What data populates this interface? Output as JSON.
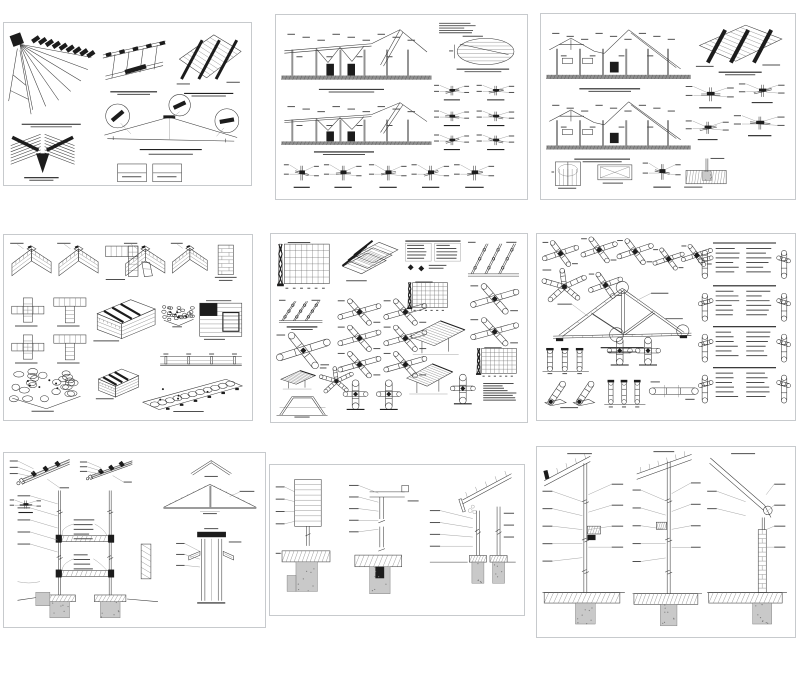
{
  "page": {
    "background": "#ffffff",
    "sheet_border": "#c7cacd",
    "ink": "#3a3a3a",
    "dark_fill": "#1c1c1c",
    "concrete_fill": "#c9c9c9",
    "grid": {
      "rows": 3,
      "cols": 3
    }
  },
  "sheets": [
    {
      "id": "sheet-1",
      "name": "roof-framing-isometrics",
      "x": 3,
      "y": 22,
      "w": 249,
      "h": 164,
      "elements": [
        {
          "t": "fan",
          "x": 1,
          "y": 5,
          "w": 35,
          "h": 54,
          "s": 1
        },
        {
          "t": "caption",
          "x": 7,
          "y": 62,
          "w": 24,
          "h": 5,
          "s": 2
        },
        {
          "t": "isobeams",
          "x": 40,
          "y": 8,
          "w": 26,
          "h": 31,
          "s": 3
        },
        {
          "t": "caption",
          "x": 43,
          "y": 42,
          "w": 19,
          "h": 5,
          "s": 4
        },
        {
          "t": "isopanel",
          "x": 70,
          "y": 6,
          "w": 27,
          "h": 34,
          "s": 5
        },
        {
          "t": "caption",
          "x": 73,
          "y": 43,
          "w": 20,
          "h": 5,
          "s": 6
        },
        {
          "t": "isocorner",
          "x": 2,
          "y": 67,
          "w": 27,
          "h": 27,
          "s": 7
        },
        {
          "t": "caption",
          "x": 8,
          "y": 95,
          "w": 14,
          "h": 5,
          "s": 8
        },
        {
          "t": "trusscall",
          "x": 37,
          "y": 47,
          "w": 60,
          "h": 37,
          "s": 9
        },
        {
          "t": "legend2",
          "x": 46,
          "y": 87,
          "w": 26,
          "h": 11,
          "s": 10
        }
      ]
    },
    {
      "id": "sheet-2",
      "name": "building-elevations-and-details",
      "x": 275,
      "y": 14,
      "w": 253,
      "h": 186,
      "elements": [
        {
          "t": "section",
          "v": "a",
          "x": 2,
          "y": 6,
          "w": 60,
          "h": 32,
          "s": 1
        },
        {
          "t": "caption",
          "x": 17,
          "y": 40,
          "w": 26,
          "h": 5,
          "s": 2
        },
        {
          "t": "section",
          "v": "a",
          "x": 2,
          "y": 46,
          "w": 60,
          "h": 27,
          "s": 3
        },
        {
          "t": "caption",
          "x": 15,
          "y": 74,
          "w": 24,
          "h": 5,
          "s": 4
        },
        {
          "t": "textblock",
          "x": 65,
          "y": 4,
          "w": 15,
          "h": 7,
          "s": 5
        },
        {
          "t": "ellipseplan",
          "x": 69,
          "y": 11,
          "w": 27,
          "h": 17,
          "s": 6
        },
        {
          "t": "caption",
          "x": 72,
          "y": 29,
          "w": 21,
          "h": 5,
          "s": 7
        },
        {
          "t": "smalldetail",
          "x": 63,
          "y": 36,
          "w": 14,
          "h": 11,
          "s": 8
        },
        {
          "t": "smalldetail",
          "x": 80,
          "y": 36,
          "w": 15,
          "h": 11,
          "s": 9
        },
        {
          "t": "smalldetail",
          "x": 63,
          "y": 50,
          "w": 14,
          "h": 11,
          "s": 10
        },
        {
          "t": "smalldetail",
          "x": 80,
          "y": 50,
          "w": 15,
          "h": 11,
          "s": 11
        },
        {
          "t": "smalldetail",
          "x": 63,
          "y": 63,
          "w": 14,
          "h": 11,
          "s": 12
        },
        {
          "t": "smalldetail",
          "x": 80,
          "y": 63,
          "w": 15,
          "h": 11,
          "s": 13
        },
        {
          "t": "smalldetail",
          "x": 3,
          "y": 78,
          "w": 14,
          "h": 17,
          "s": 14
        },
        {
          "t": "smalldetail",
          "x": 19,
          "y": 78,
          "w": 15,
          "h": 17,
          "s": 15
        },
        {
          "t": "smalldetail",
          "x": 37,
          "y": 78,
          "w": 15,
          "h": 17,
          "s": 16
        },
        {
          "t": "smalldetail",
          "x": 54,
          "y": 78,
          "w": 15,
          "h": 17,
          "s": 17
        },
        {
          "t": "smalldetail",
          "x": 71,
          "y": 78,
          "w": 16,
          "h": 17,
          "s": 18
        }
      ]
    },
    {
      "id": "sheet-3",
      "name": "asymmetric-roof-sections-and-details",
      "x": 540,
      "y": 13,
      "w": 256,
      "h": 187,
      "elements": [
        {
          "t": "section",
          "v": "b",
          "x": 2,
          "y": 6,
          "w": 57,
          "h": 32,
          "s": 1
        },
        {
          "t": "caption",
          "x": 15,
          "y": 40,
          "w": 24,
          "h": 5,
          "s": 2
        },
        {
          "t": "section",
          "v": "b",
          "x": 2,
          "y": 45,
          "w": 57,
          "h": 31,
          "s": 3
        },
        {
          "t": "caption",
          "x": 13,
          "y": 78,
          "w": 22,
          "h": 5,
          "s": 4
        },
        {
          "t": "isopanel",
          "x": 61,
          "y": 5,
          "w": 35,
          "h": 25,
          "s": 5
        },
        {
          "t": "caption",
          "x": 70,
          "y": 31,
          "w": 17,
          "h": 5,
          "s": 6
        },
        {
          "t": "smalldetail",
          "x": 57,
          "y": 36,
          "w": 19,
          "h": 16,
          "s": 7
        },
        {
          "t": "smalldetail",
          "x": 78,
          "y": 35,
          "w": 18,
          "h": 14,
          "s": 8
        },
        {
          "t": "smalldetail",
          "x": 57,
          "y": 55,
          "w": 17,
          "h": 14,
          "s": 9
        },
        {
          "t": "smalldetail",
          "x": 76,
          "y": 52,
          "w": 20,
          "h": 15,
          "s": 10
        },
        {
          "t": "opening",
          "v": "door",
          "x": 4,
          "y": 79,
          "w": 13,
          "h": 16,
          "s": 11
        },
        {
          "t": "opening",
          "v": "window",
          "x": 21,
          "y": 80,
          "w": 16,
          "h": 13,
          "s": 12
        },
        {
          "t": "smalldetail",
          "x": 40,
          "y": 77,
          "w": 15,
          "h": 18,
          "s": 13
        },
        {
          "t": "foundsec",
          "x": 56,
          "y": 77,
          "w": 18,
          "h": 18,
          "s": 14
        }
      ]
    },
    {
      "id": "sheet-4",
      "name": "masonry-bond-details",
      "x": 3,
      "y": 234,
      "w": 250,
      "h": 187,
      "elements": [
        {
          "t": "brickiso",
          "v": "l",
          "x": 2,
          "y": 4,
          "w": 18,
          "h": 25,
          "s": 1
        },
        {
          "t": "brickiso",
          "v": "l",
          "x": 21,
          "y": 4,
          "w": 18,
          "h": 25,
          "s": 2
        },
        {
          "t": "brickplan",
          "v": "l",
          "x": 41,
          "y": 6,
          "w": 13,
          "h": 19,
          "s": 3
        },
        {
          "t": "brickiso",
          "v": "t",
          "x": 48,
          "y": 4,
          "w": 18,
          "h": 25,
          "s": 4
        },
        {
          "t": "brickiso",
          "v": "l",
          "x": 67,
          "y": 4,
          "w": 16,
          "h": 23,
          "s": 5
        },
        {
          "t": "brickcol",
          "x": 84,
          "y": 5,
          "w": 11,
          "h": 21,
          "s": 6
        },
        {
          "t": "brickplan",
          "v": "x",
          "x": 3,
          "y": 34,
          "w": 13,
          "h": 16,
          "s": 7
        },
        {
          "t": "brickplan",
          "v": "t",
          "x": 20,
          "y": 34,
          "w": 13,
          "h": 16,
          "s": 8
        },
        {
          "t": "brickplan",
          "v": "x",
          "x": 3,
          "y": 54,
          "w": 13,
          "h": 16,
          "s": 9
        },
        {
          "t": "brickplan",
          "v": "t",
          "x": 20,
          "y": 54,
          "w": 13,
          "h": 16,
          "s": 10
        },
        {
          "t": "brickisowall",
          "x": 36,
          "y": 33,
          "w": 26,
          "h": 25,
          "s": 11
        },
        {
          "t": "stoneiso",
          "x": 64,
          "y": 37,
          "w": 13,
          "h": 13,
          "s": 12
        },
        {
          "t": "brickelev",
          "x": 79,
          "y": 35,
          "w": 17,
          "h": 23,
          "s": 13
        },
        {
          "t": "wallstrip",
          "x": 63,
          "y": 63,
          "w": 33,
          "h": 9,
          "s": 14
        },
        {
          "t": "stoneiso",
          "x": 2,
          "y": 70,
          "w": 30,
          "h": 26,
          "s": 15
        },
        {
          "t": "brickisowall",
          "x": 37,
          "y": 71,
          "w": 18,
          "h": 18,
          "s": 16
        },
        {
          "t": "stonewalliso",
          "x": 56,
          "y": 76,
          "w": 41,
          "h": 20,
          "s": 17
        }
      ]
    },
    {
      "id": "sheet-5",
      "name": "bamboo-lashing-and-roof-details",
      "x": 270,
      "y": 233,
      "w": 258,
      "h": 190,
      "elements": [
        {
          "t": "mesh",
          "x": 2,
          "y": 4,
          "w": 22,
          "h": 27,
          "s": 1
        },
        {
          "t": "layeredroof",
          "x": 27,
          "y": 4,
          "w": 23,
          "h": 22,
          "s": 2
        },
        {
          "t": "texttable",
          "x": 52,
          "y": 3,
          "w": 23,
          "h": 19,
          "s": 3
        },
        {
          "t": "battens",
          "x": 77,
          "y": 4,
          "w": 20,
          "h": 20,
          "s": 4
        },
        {
          "t": "battens",
          "x": 3,
          "y": 35,
          "w": 17,
          "h": 13,
          "s": 5
        },
        {
          "t": "caption",
          "x": 6,
          "y": 49,
          "w": 12,
          "h": 4,
          "s": 6
        },
        {
          "t": "bambooX",
          "x": 2,
          "y": 53,
          "w": 21,
          "h": 18,
          "s": 7
        },
        {
          "t": "thatch",
          "x": 3,
          "y": 72,
          "w": 15,
          "h": 11,
          "s": 8
        },
        {
          "t": "star",
          "x": 19,
          "y": 71,
          "w": 13,
          "h": 14,
          "s": 9
        },
        {
          "t": "trapframe",
          "x": 2,
          "y": 85,
          "w": 20,
          "h": 13,
          "s": 10
        },
        {
          "t": "bambooX",
          "x": 26,
          "y": 35,
          "w": 17,
          "h": 13,
          "s": 11
        },
        {
          "t": "bambooX",
          "x": 44,
          "y": 35,
          "w": 17,
          "h": 13,
          "s": 12
        },
        {
          "t": "bambooX",
          "x": 26,
          "y": 49,
          "w": 17,
          "h": 13,
          "s": 13
        },
        {
          "t": "bambooX",
          "x": 44,
          "y": 49,
          "w": 17,
          "h": 13,
          "s": 14
        },
        {
          "t": "bambooX",
          "x": 26,
          "y": 63,
          "w": 17,
          "h": 13,
          "s": 15
        },
        {
          "t": "bambooX",
          "x": 44,
          "y": 63,
          "w": 17,
          "h": 13,
          "s": 16
        },
        {
          "t": "vertjoint",
          "x": 28,
          "y": 78,
          "w": 10,
          "h": 17,
          "s": 17
        },
        {
          "t": "vertjoint",
          "x": 41,
          "y": 78,
          "w": 10,
          "h": 17,
          "s": 18
        },
        {
          "t": "mesh",
          "x": 53,
          "y": 25,
          "w": 17,
          "h": 17,
          "s": 19
        },
        {
          "t": "thatch",
          "x": 53,
          "y": 45,
          "w": 24,
          "h": 20,
          "s": 20
        },
        {
          "t": "thatch",
          "x": 52,
          "y": 68,
          "w": 20,
          "h": 18,
          "s": 21
        },
        {
          "t": "bambooX",
          "x": 78,
          "y": 27,
          "w": 19,
          "h": 15,
          "s": 22
        },
        {
          "t": "bambooX",
          "x": 78,
          "y": 45,
          "w": 19,
          "h": 14,
          "s": 23
        },
        {
          "t": "mesh",
          "x": 80,
          "y": 60,
          "w": 17,
          "h": 17,
          "s": 24
        },
        {
          "t": "vertjoint",
          "x": 70,
          "y": 75,
          "w": 10,
          "h": 17,
          "s": 25
        },
        {
          "t": "textblock",
          "x": 83,
          "y": 79,
          "w": 13,
          "h": 11,
          "s": 26
        }
      ]
    },
    {
      "id": "sheet-6",
      "name": "bamboo-truss-and-joint-details",
      "x": 536,
      "y": 233,
      "w": 260,
      "h": 188,
      "elements": [
        {
          "t": "bambooX",
          "x": 2,
          "y": 4,
          "w": 14,
          "h": 13,
          "s": 1
        },
        {
          "t": "bambooX",
          "x": 17,
          "y": 2,
          "w": 14,
          "h": 13,
          "s": 2
        },
        {
          "t": "bambooX",
          "x": 31,
          "y": 3,
          "w": 14,
          "h": 13,
          "s": 3
        },
        {
          "t": "bambooX",
          "x": 45,
          "y": 8,
          "w": 12,
          "h": 11,
          "s": 4
        },
        {
          "t": "bambooX",
          "x": 56,
          "y": 6,
          "w": 12,
          "h": 11,
          "s": 5
        },
        {
          "t": "star",
          "x": 2,
          "y": 19,
          "w": 17,
          "h": 18,
          "s": 6
        },
        {
          "t": "bambooX",
          "x": 20,
          "y": 21,
          "w": 13,
          "h": 13,
          "s": 7
        },
        {
          "t": "btruss",
          "x": 5,
          "y": 26,
          "w": 56,
          "h": 39,
          "s": 8
        },
        {
          "t": "vertjoint",
          "x": 27,
          "y": 56,
          "w": 10,
          "h": 16,
          "s": 9
        },
        {
          "t": "vertjoint",
          "x": 38,
          "y": 56,
          "w": 10,
          "h": 16,
          "s": 10
        },
        {
          "t": "posts3",
          "x": 2,
          "y": 60,
          "w": 18,
          "h": 16,
          "s": 11
        },
        {
          "t": "leanpost",
          "x": 2,
          "y": 77,
          "w": 23,
          "h": 17,
          "s": 12
        },
        {
          "t": "posts3",
          "x": 26,
          "y": 77,
          "w": 16,
          "h": 17,
          "s": 13
        },
        {
          "t": "hcyl",
          "x": 44,
          "y": 79,
          "w": 18,
          "h": 11,
          "s": 14
        },
        {
          "t": "btext",
          "x": 63,
          "y": 4,
          "w": 35,
          "h": 21,
          "s": 15
        },
        {
          "t": "btext",
          "x": 63,
          "y": 27,
          "w": 35,
          "h": 21,
          "s": 16
        },
        {
          "t": "btext",
          "x": 63,
          "y": 49,
          "w": 35,
          "h": 21,
          "s": 17
        },
        {
          "t": "btext",
          "x": 63,
          "y": 71,
          "w": 35,
          "h": 21,
          "s": 18
        }
      ]
    },
    {
      "id": "sheet-7",
      "name": "two-story-wall-sections",
      "x": 3,
      "y": 452,
      "w": 263,
      "h": 176,
      "elements": [
        {
          "t": "eaveiso",
          "x": 2,
          "y": 3,
          "w": 24,
          "h": 20,
          "s": 1
        },
        {
          "t": "eaveiso",
          "x": 29,
          "y": 4,
          "w": 21,
          "h": 15,
          "s": 2
        },
        {
          "t": "smalldetail",
          "x": 2,
          "y": 25,
          "w": 12,
          "h": 10,
          "s": 3
        },
        {
          "t": "twostory",
          "x": 5,
          "y": 20,
          "w": 54,
          "h": 77,
          "s": 4
        },
        {
          "t": "ridge",
          "x": 71,
          "y": 3,
          "w": 17,
          "h": 11,
          "s": 5
        },
        {
          "t": "gable",
          "x": 60,
          "y": 16,
          "w": 38,
          "h": 20,
          "s": 6
        },
        {
          "t": "chimney",
          "x": 66,
          "y": 43,
          "w": 27,
          "h": 45,
          "s": 7
        }
      ]
    },
    {
      "id": "sheet-8",
      "name": "wall-base-and-foundation-details",
      "x": 269,
      "y": 464,
      "w": 256,
      "h": 152,
      "elements": [
        {
          "t": "siding",
          "x": 2,
          "y": 8,
          "w": 25,
          "h": 82,
          "s": 1
        },
        {
          "t": "lbeam",
          "x": 31,
          "y": 5,
          "w": 29,
          "h": 86,
          "s": 2
        },
        {
          "t": "eavecol",
          "x": 63,
          "y": 4,
          "w": 34,
          "h": 88,
          "s": 3
        }
      ]
    },
    {
      "id": "sheet-9",
      "name": "full-height-wall-sections",
      "x": 536,
      "y": 446,
      "w": 260,
      "h": 192,
      "elements": [
        {
          "t": "tallsec",
          "v": "a",
          "x": 2,
          "y": 3,
          "w": 32,
          "h": 92,
          "s": 1
        },
        {
          "t": "tallsec",
          "v": "b",
          "x": 37,
          "y": 2,
          "w": 27,
          "h": 94,
          "s": 2
        },
        {
          "t": "tallsec",
          "v": "c",
          "x": 66,
          "y": 3,
          "w": 31,
          "h": 92,
          "s": 3
        }
      ]
    }
  ]
}
